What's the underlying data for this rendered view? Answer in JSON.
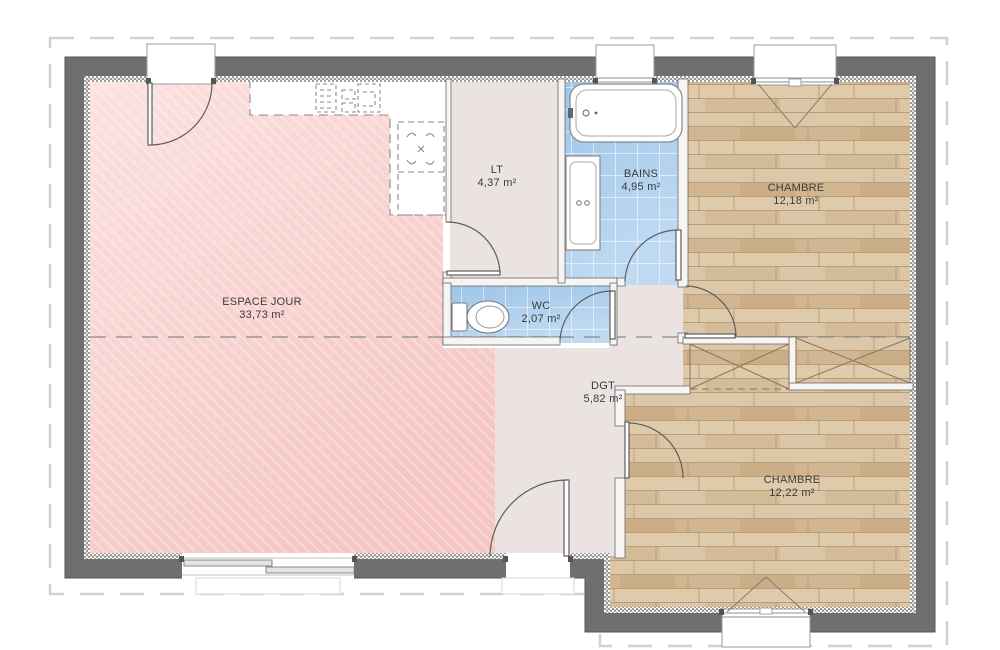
{
  "plan": {
    "rooms": [
      {
        "name": "ESPACE JOUR",
        "area": "33,73 m²"
      },
      {
        "name": "LT",
        "area": "4,37 m²"
      },
      {
        "name": "BAINS",
        "area": "4,95 m²"
      },
      {
        "name": "WC",
        "area": "2,07 m²"
      },
      {
        "name": "DGT",
        "area": "5,82 m²"
      },
      {
        "name": "CHAMBRE",
        "area": "12,18 m²"
      },
      {
        "name": "CHAMBRE",
        "area": "12,22 m²"
      }
    ],
    "fixtures": [
      "bathtub",
      "vanity",
      "toilet",
      "kitchen-counter",
      "fridge",
      "wardrobe",
      "wardrobe"
    ],
    "colors": {
      "wall": "#6f6f6f",
      "roof-dash": "#d2d2d2",
      "living-pink": "#f6cbc8",
      "service-beige": "#ebe3e1",
      "wet-blue": "#a9cdec",
      "wood": "#d8c09e",
      "label-text": "#3c3c3c"
    }
  }
}
